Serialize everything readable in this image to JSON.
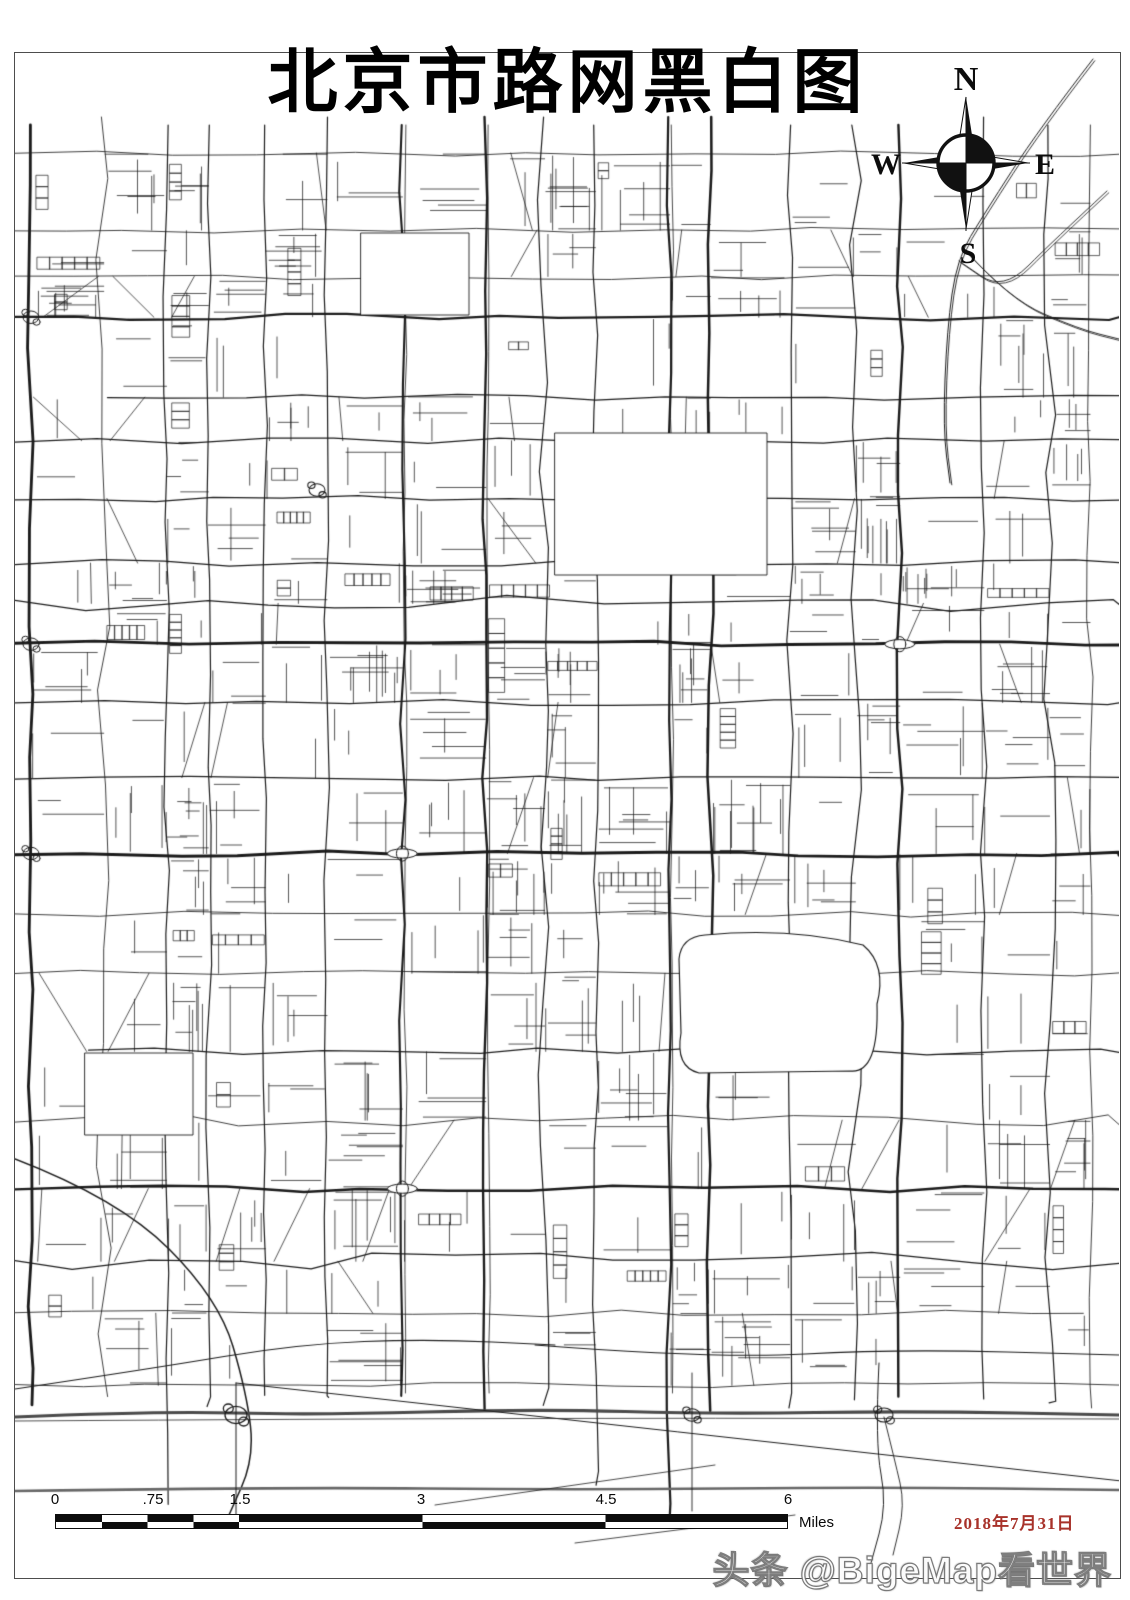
{
  "map": {
    "title": "北京市路网黑白图",
    "date_label": "2018年7月31日",
    "date_color": "#a8322a",
    "road_color": "#1b1b1b",
    "gray_road_color": "#4a4a4a",
    "frame_color": "#4d4d4d",
    "background": "#ffffff"
  },
  "compass": {
    "north": "N",
    "south": "S",
    "west": "W",
    "east": "E"
  },
  "scale_bar": {
    "tick_labels": [
      "0",
      ".75",
      "1.5",
      "3",
      "4.5",
      "6"
    ],
    "unit_label": "Miles"
  },
  "watermark": {
    "text": "头条 @BigeMap看世界"
  }
}
